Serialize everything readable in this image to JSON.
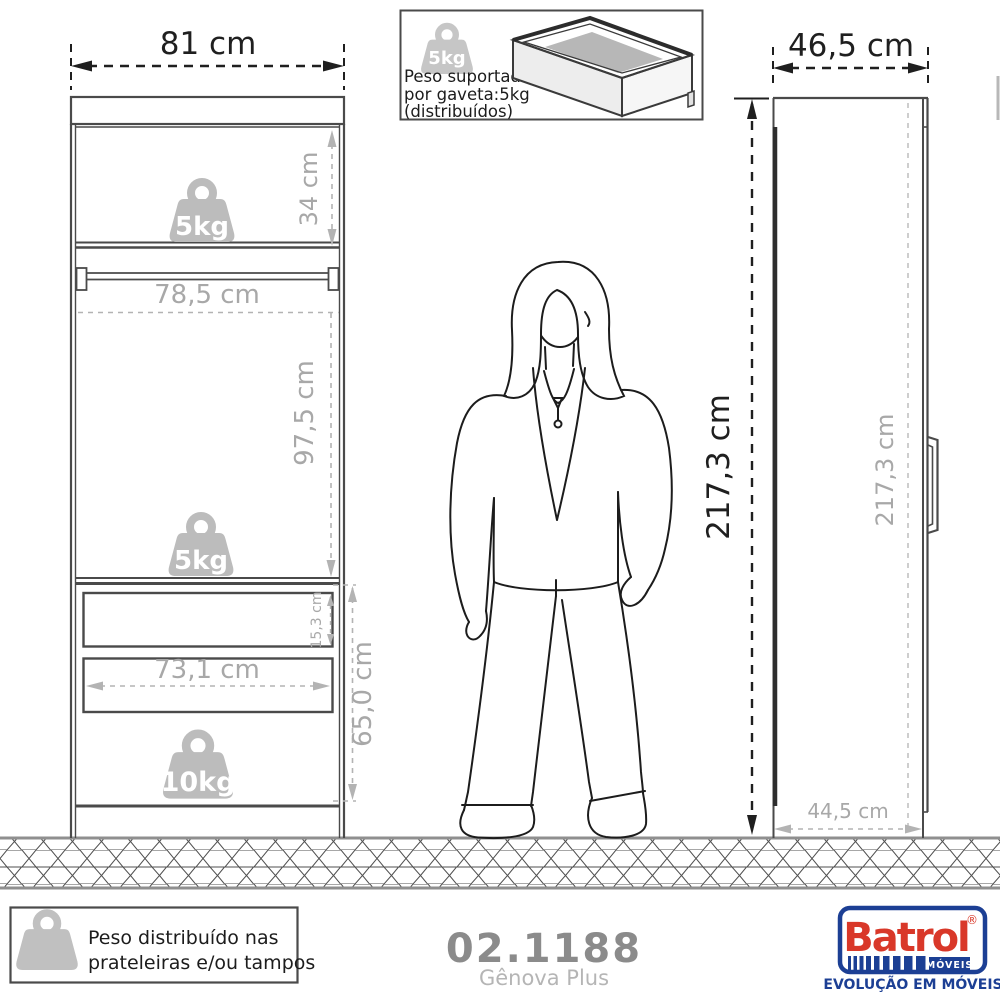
{
  "front_view": {
    "width_label": "81 cm",
    "top_section_height": "34 cm",
    "inner_width": "78,5 cm",
    "middle_section_height": "97,5 cm",
    "drawer_front_height": "15,3 cm",
    "drawer_inner_width": "73,1 cm",
    "lower_section_height": "65,0 cm",
    "top_shelf_weight": "5kg",
    "middle_shelf_weight": "5kg",
    "drawer_area_weight": "10kg"
  },
  "overall": {
    "height_label": "217,3 cm"
  },
  "side_view": {
    "depth_label": "46,5 cm",
    "inner_height": "217,3 cm",
    "base_depth": "44,5 cm"
  },
  "drawer_note": {
    "icon_weight": "5kg",
    "line1": "Peso suportado",
    "line2": "por gaveta:5kg",
    "line3": "(distribuídos)"
  },
  "distribution_note": {
    "line1": "Peso distribuído nas",
    "line2": "prateleiras e/ou tampos"
  },
  "product": {
    "code": "02.1188",
    "name": "Gênova Plus"
  },
  "brand": {
    "name": "Batrol",
    "registered": "®",
    "division": "MÓVEIS",
    "tagline": "EVOLUÇÃO EM MÓVEIS",
    "red": "#d93829",
    "navy": "#1c3f94"
  }
}
